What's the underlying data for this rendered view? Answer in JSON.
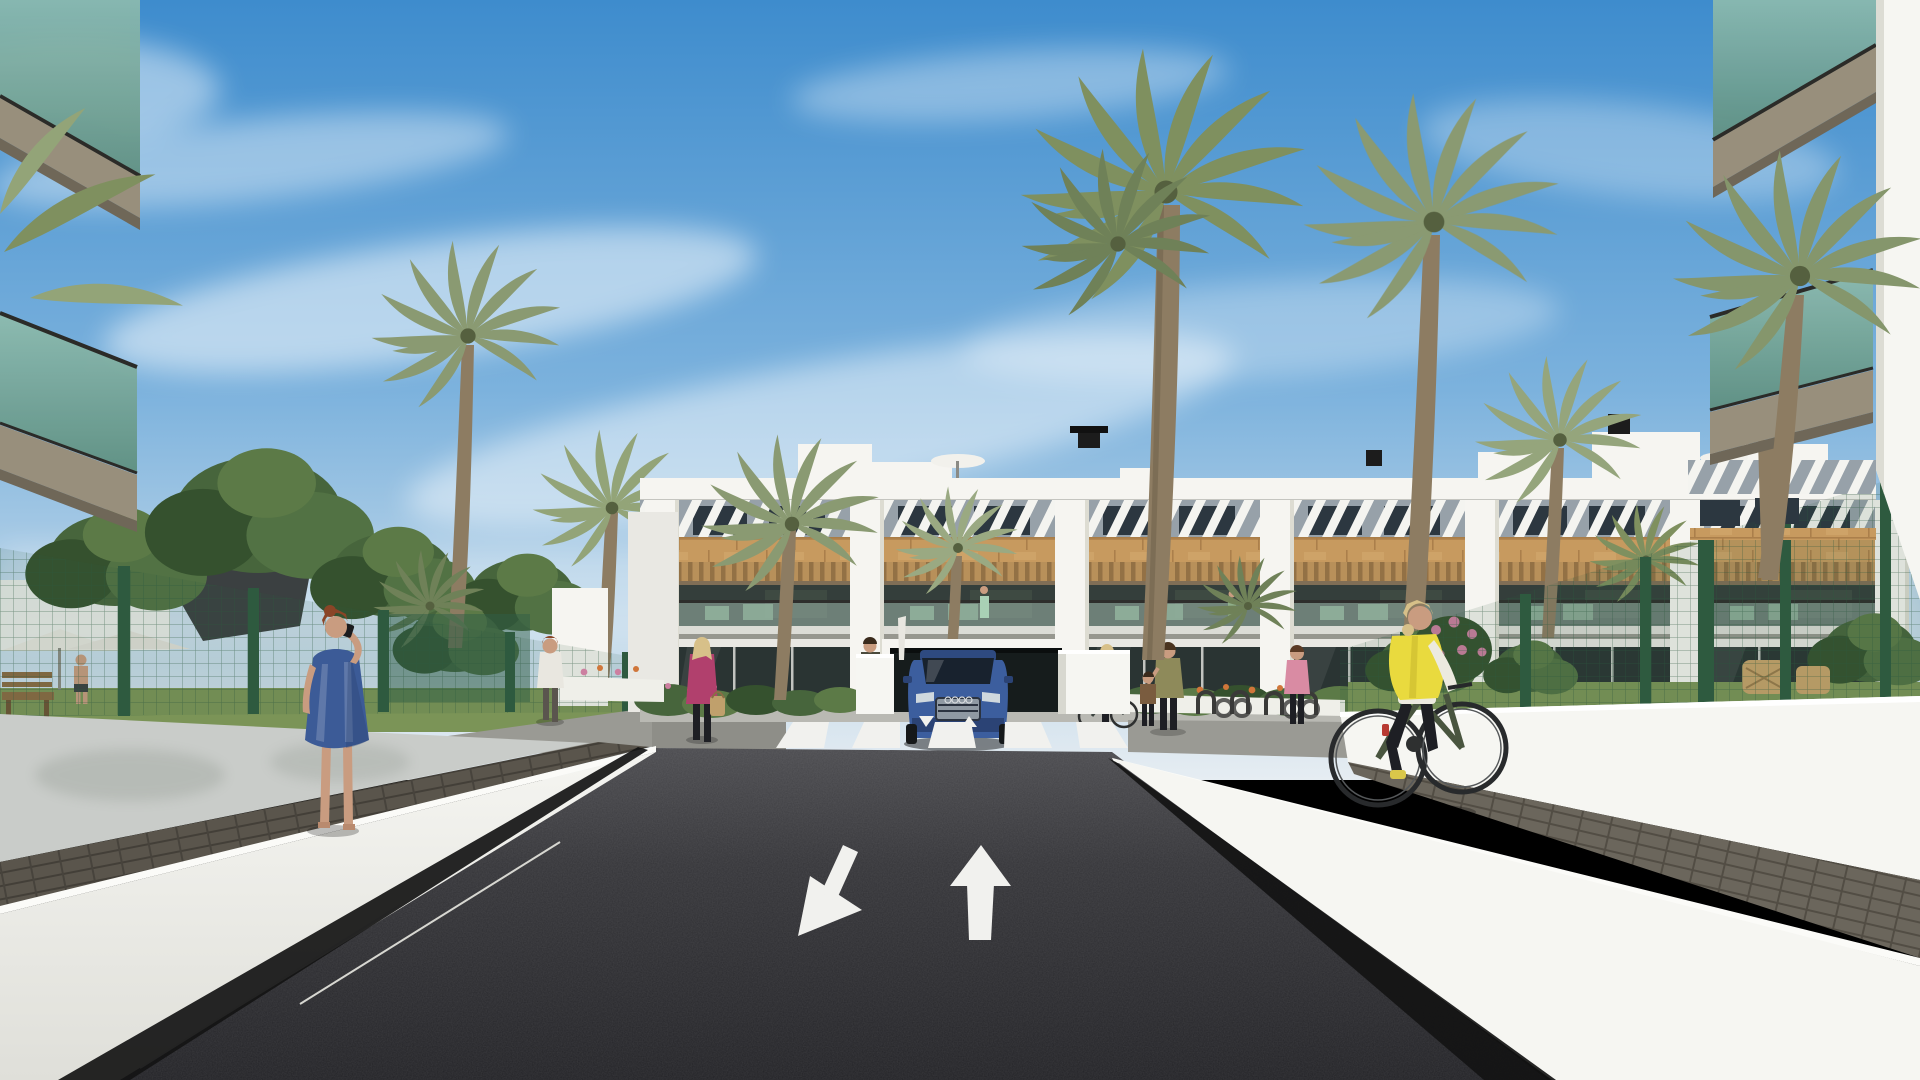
{
  "scene": {
    "type": "architectural-3d-render",
    "setting": "new-build Mediterranean apartment complex seen from the access road",
    "time_of_day": "sunny day, blue sky with thin cirrus clouds",
    "no_visible_text": true
  },
  "road": {
    "surface": "dark asphalt",
    "lane_markings": [
      "large down-left arrow (exit lane)",
      "large up arrow (entry lane)"
    ],
    "crosswalk_stripes": 5,
    "small_ramp_arrows": [
      "tiny down arrow",
      "tiny up arrow"
    ],
    "leads_to": "underground garage ramp beneath central building"
  },
  "building": {
    "floors": 3,
    "style": "white render with wood-clad band, diagonal louver sunshades on top floor, wood pergolas over balconies",
    "balcony_bays": 6,
    "rooftop": [
      "white stair boxes",
      "black chimney cowls",
      "2 white parasols"
    ],
    "balcony_furniture_color": "sage green"
  },
  "people": [
    {
      "name": "woman-blue-dress",
      "detail": "auburn hair, blue patterned dress, phone to ear, walking away on left walkway"
    },
    {
      "name": "cyclist",
      "detail": "blonde woman, yellow vest, white sleeves, black trousers, dark green bicycle, right walkway"
    },
    {
      "name": "man-white-tshirt",
      "detail": "walking up garden path, left of center"
    },
    {
      "name": "woman-magenta-jacket",
      "detail": "blonde, black trousers, tan handbag, near left crosswalk end"
    },
    {
      "name": "person-dark-outfit",
      "detail": "standing left of garage ramp"
    },
    {
      "name": "mother-and-child",
      "detail": "right pavement near bike racks"
    },
    {
      "name": "woman-pushing-bike",
      "detail": "red bag, right pavement"
    },
    {
      "name": "woman-pink-top",
      "detail": "right pavement"
    },
    {
      "name": "shirtless-man",
      "detail": "far left garden behind fence"
    },
    {
      "name": "balcony-residents",
      "detail": "two tiny figures on first-floor balconies"
    }
  ],
  "vegetation": {
    "tall_palms": 8,
    "garden": [
      "bushy green trees left",
      "flower beds orange and pink",
      "lawn strips",
      "hedges"
    ]
  },
  "foreground": {
    "left": "cropped glass balconies of near building (green-tinted glass, taupe soffits)",
    "right": "cropped glass balconies and white wall edge of near building",
    "walls": "white access-ramp walls with dark paver walkways behind them",
    "fences": "dark green mesh fences on both sides"
  },
  "palette": {
    "sky-top": "#3e8ccd",
    "sky-mid": "#7cb2dd",
    "sky-low": "#c2d9ea",
    "sky-horizon": "#e6edf2",
    "bldg-white": "#f6f5f1",
    "bldg-shade": "#e9e8e3",
    "louver-base": "#97a1a9",
    "louver-stripe": "#f4f4f0",
    "window-dark": "#2c3740",
    "wood": "#c79a5f",
    "pergola": "#b8905a",
    "pergola-shadow": "#6e5230",
    "balcony-interior": "#343e3b",
    "furniture-green": "#7ca284",
    "glass-rail": "#a6c0b4",
    "slab": "#dcdcd6",
    "slab-shadow": "#97978f",
    "ground-glass": "#2a3433",
    "garage-dark": "#161c1c",
    "grass": "#7b9457",
    "bush": "#47653c",
    "bush-dark": "#35512e",
    "bush-light": "#5c7a47",
    "palm-frond": "#8a9a72",
    "trunk": "#8d7c62",
    "fence-green": "#2e5a3f",
    "wall-bright": "#f6f6f2",
    "wall-gray": "#c9ccc9",
    "walkway": "#57524a",
    "asphalt-top": "#49494d",
    "asphalt-bottom": "#222226",
    "road-white": "#f1f1ee",
    "base-black": "#141414",
    "glass-teal": "#79a896",
    "soffit": "#988f7c",
    "soffit-dark": "#6f6758",
    "skin": "#c99c80",
    "dress-blue": "#3c5b97",
    "hair-auburn": "#8a4527",
    "vest-yellow": "#e9da3e",
    "sleeve-white": "#eceadf",
    "pants-black": "#1e1f24",
    "hair-blonde": "#d7c089",
    "bike-green": "#49553f",
    "tire": "#282a2c",
    "car-blue": "#3c5e9e",
    "car-blue-dark": "#2b4375",
    "car-glass": "#18222e",
    "car-grille": "#8f99a3",
    "magenta": "#b1406d",
    "bag-tan": "#c0a06c",
    "tee-white": "#e9e7e0",
    "flower-orange": "#d0763a",
    "flower-pink": "#cc7fa0",
    "wicker": "#c8a36a",
    "sail-dark": "#3b4041",
    "bench-wood": "#8a6a42",
    "path-gray": "#b9b9b3",
    "planter-white": "#efefe9"
  }
}
